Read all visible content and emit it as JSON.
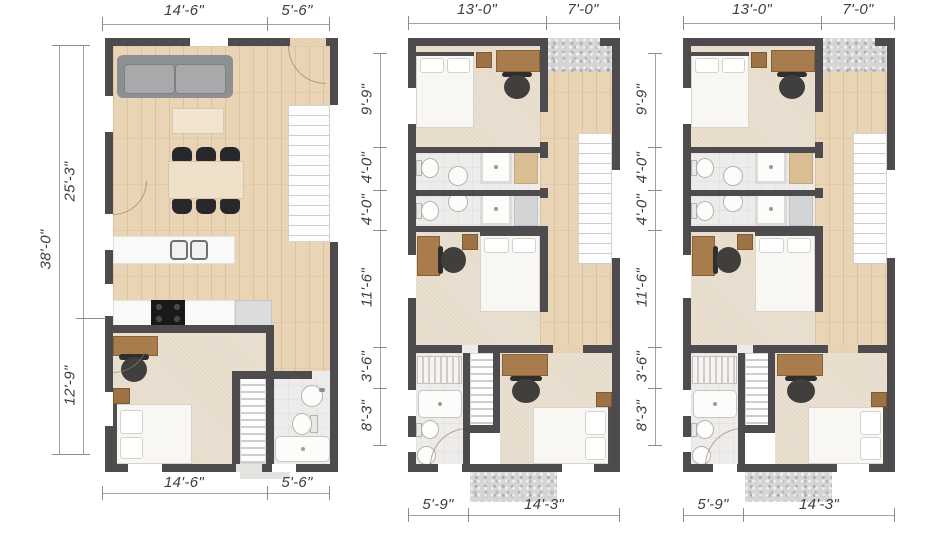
{
  "palette": {
    "wall": "#4d4b4e",
    "wood_floor": "#e9d4b5",
    "carpet": "#ebe1d2",
    "tile": "#edeceb",
    "concrete": "#d7d5d3",
    "dimension_text": "#3e3e3e"
  },
  "plans": [
    {
      "name": "unit-plan-1",
      "dims_top": [
        "14'-6\"",
        "5'-6\""
      ],
      "dims_left_outer": "38'-0\"",
      "dims_left": [
        "25'-3\"",
        "12'-9\""
      ],
      "dims_bottom": [
        "14'-6\"",
        "5'-6\""
      ]
    },
    {
      "name": "unit-plan-2",
      "dims_top": [
        "13'-0\"",
        "7'-0\""
      ],
      "dims_left": [
        "9'-9\"",
        "4'-0\"",
        "4'-0\"",
        "11'-6\"",
        "3'-6\"",
        "8'-3\""
      ],
      "dims_bottom": [
        "5'-9\"",
        "14'-3\""
      ]
    },
    {
      "name": "unit-plan-3",
      "dims_top": [
        "13'-0\"",
        "7'-0\""
      ],
      "dims_left": [
        "9'-9\"",
        "4'-0\"",
        "4'-0\"",
        "11'-6\"",
        "3'-6\"",
        "8'-3\""
      ],
      "dims_bottom": [
        "5'-9\"",
        "14'-3\""
      ]
    }
  ]
}
